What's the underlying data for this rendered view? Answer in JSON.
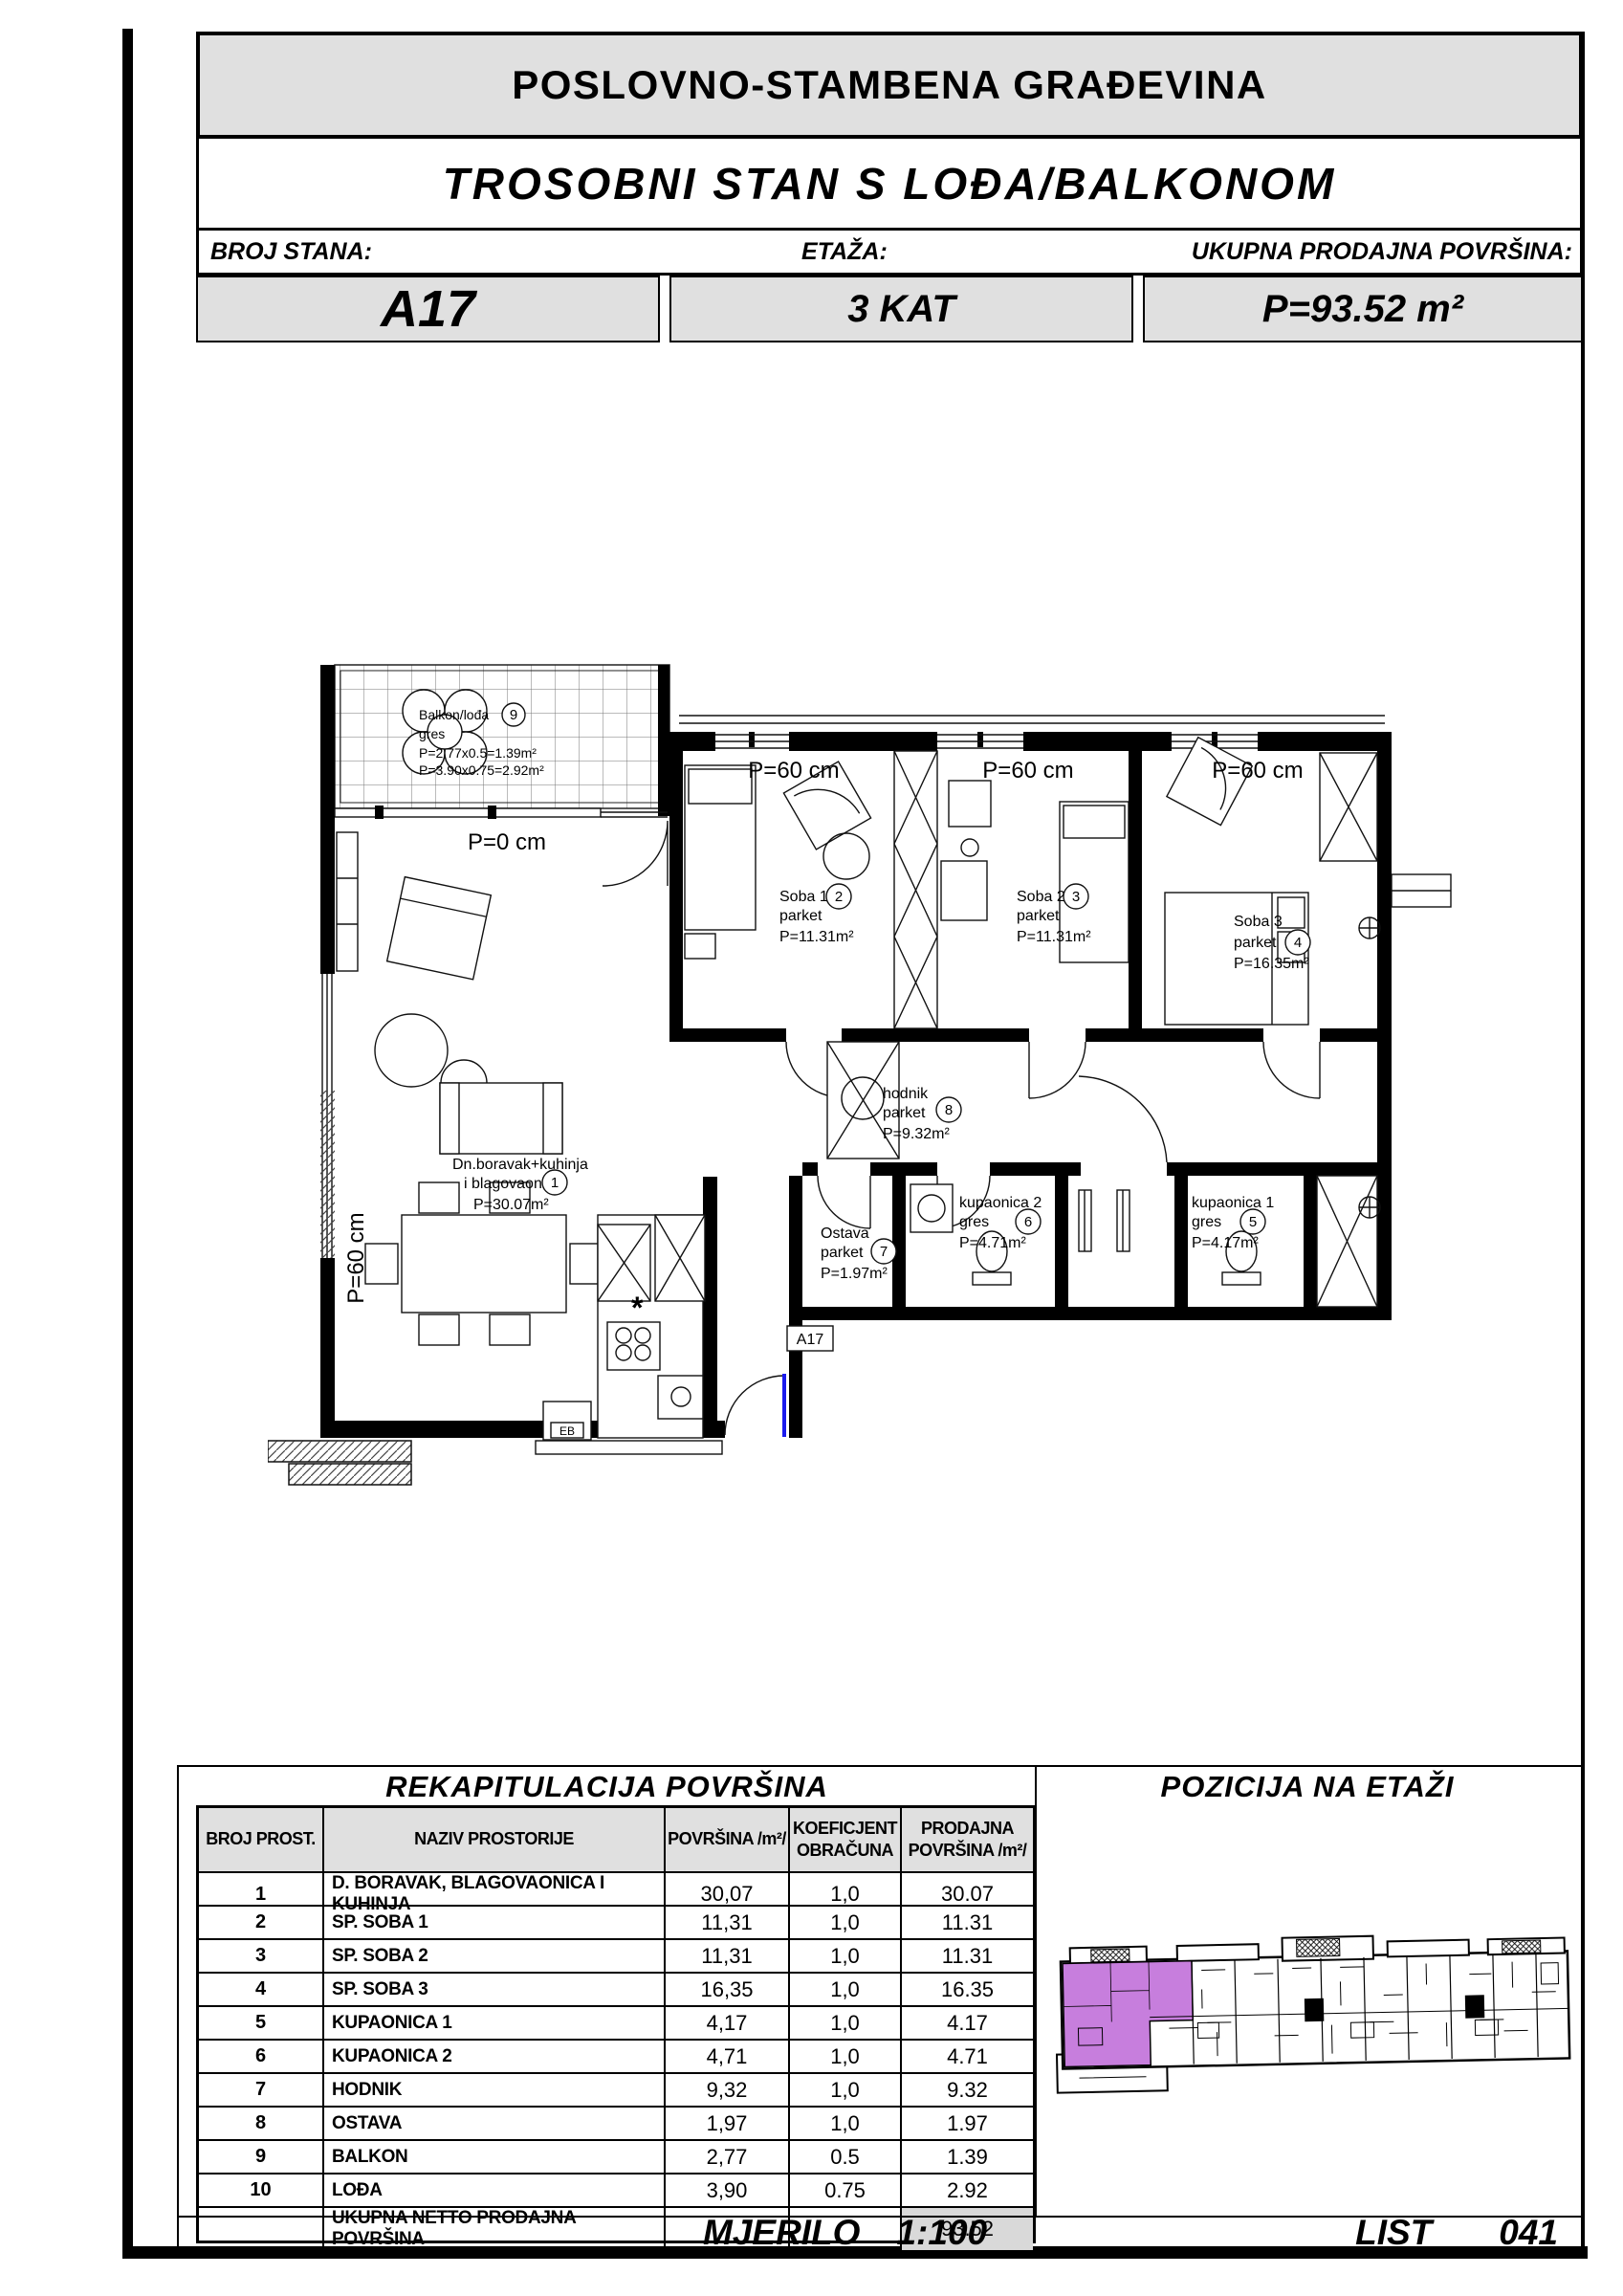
{
  "header": {
    "title": "POSLOVNO-STAMBENA GRAĐEVINA",
    "subtitle": "TROSOBNI STAN S LOĐA/BALKONOM",
    "fields": [
      {
        "label": "BROJ STANA:",
        "value": "A17"
      },
      {
        "label": "ETAŽA:",
        "value": "3 KAT"
      },
      {
        "label": "UKUPNA PRODAJNA POVRŠINA:",
        "value": "P=93.52 m²"
      }
    ]
  },
  "plan": {
    "apartment_box": "A17",
    "parapet_zero": "P=0 cm",
    "parapet_sixty": "P=60 cm",
    "kitchen_boiler": "EB",
    "star": "*",
    "balcony": {
      "name": "Balkon/lođa",
      "num": "9",
      "floor": "gres",
      "calc1": "P=2.77x0.5=1.39m²",
      "calc2": "P=3.90x0.75=2.92m²"
    },
    "rooms": [
      {
        "num": "1",
        "line1": "Dn.boravak+kuhinja",
        "line2": "i blagovaona",
        "area": "P=30.07m²"
      },
      {
        "num": "2",
        "line1": "Soba 1",
        "line2": "parket",
        "area": "P=11.31m²"
      },
      {
        "num": "3",
        "line1": "Soba 2",
        "line2": "parket",
        "area": "P=11.31m²"
      },
      {
        "num": "4",
        "line1": "Soba 3",
        "line2": "parket",
        "area": "P=16.35m²"
      },
      {
        "num": "5",
        "line1": "kupaonica 1",
        "line2": "gres",
        "area": "P=4.17m²"
      },
      {
        "num": "6",
        "line1": "kupaonica 2",
        "line2": "gres",
        "area": "P=4.71m²"
      },
      {
        "num": "7",
        "line1": "Ostava",
        "line2": "parket",
        "area": "P=1.97m²"
      },
      {
        "num": "8",
        "line1": "hodnik",
        "line2": "parket",
        "area": "P=9.32m²"
      }
    ]
  },
  "recap": {
    "title": "REKAPITULACIJA POVRŠINA",
    "columns": [
      [
        "BROJ PROST.",
        ""
      ],
      [
        "NAZIV PROSTORIJE",
        ""
      ],
      [
        "POVRŠINA  /m²/",
        ""
      ],
      [
        "KOEFICJENT",
        "OBRAČUNA"
      ],
      [
        "PRODAJNA",
        "POVRŠINA /m²/"
      ]
    ],
    "rows": [
      [
        "1",
        "D. BORAVAK, BLAGOVAONICA I KUHINJA",
        "30,07",
        "1,0",
        "30.07"
      ],
      [
        "2",
        "SP. SOBA 1",
        "11,31",
        "1,0",
        "11.31"
      ],
      [
        "3",
        "SP. SOBA 2",
        "11,31",
        "1,0",
        "11.31"
      ],
      [
        "4",
        "SP. SOBA 3",
        "16,35",
        "1,0",
        "16.35"
      ],
      [
        "5",
        "KUPAONICA 1",
        "4,17",
        "1,0",
        "4.17"
      ],
      [
        "6",
        "KUPAONICA 2",
        "4,71",
        "1,0",
        "4.71"
      ],
      [
        "7",
        "HODNIK",
        "9,32",
        "1,0",
        "9.32"
      ],
      [
        "8",
        "OSTAVA",
        "1,97",
        "1,0",
        "1.97"
      ],
      [
        "9",
        "BALKON",
        "2,77",
        "0.5",
        "1.39"
      ],
      [
        "10",
        "LOĐA",
        "3,90",
        "0.75",
        "2.92"
      ]
    ],
    "total_label": "UKUPNA NETTO PRODAJNA POVRŠINA",
    "total_value": "93.52"
  },
  "position": {
    "title": "POZICIJA NA ETAŽI",
    "highlight_color": "#c77edd"
  },
  "footer": {
    "scale_word": "MJERILO",
    "scale_value": "1:100",
    "sheet_word": "LIST",
    "sheet_number": "041"
  }
}
